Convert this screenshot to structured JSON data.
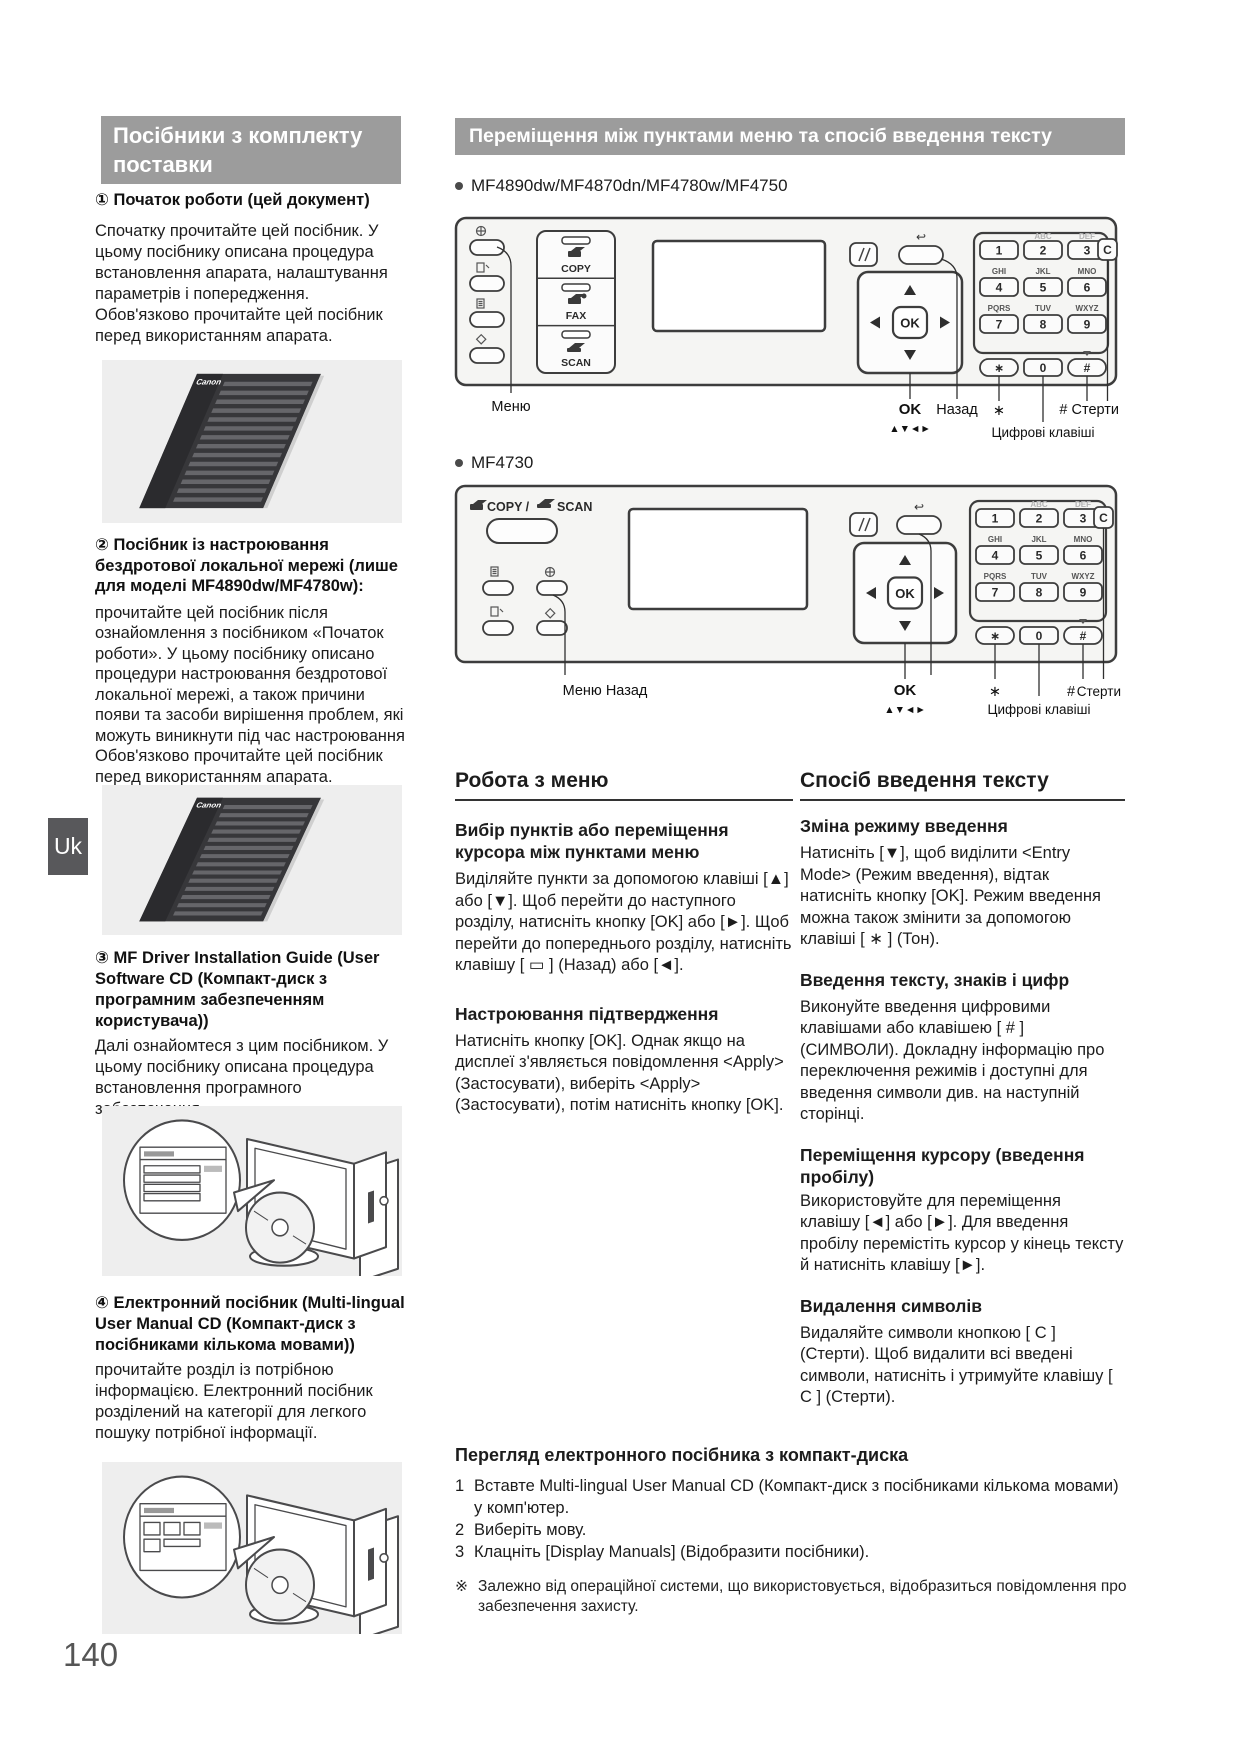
{
  "page": {
    "number": "140",
    "lang_tab": "Uk"
  },
  "left": {
    "header": "Посібники з комплекту поставки",
    "booklet_logo": "Canon",
    "sections": [
      {
        "title": "① Початок роботи (цей документ)",
        "body": "Спочатку прочитайте цей посібник. У цьому посібнику описана процедура встановлення апарата, налаштування параметрів і попередження. Обов'язково прочитайте цей посібник перед використанням апарата."
      },
      {
        "title": "② Посібник із настроювання бездротової локальної мережі (лише для моделі MF4890dw/MF4780w):",
        "body": "прочитайте цей посібник після ознайомлення з посібником «Початок роботи». У цьому посібнику описано процедури настроювання бездротової локальної мережі, а також причини появи та засоби вирішення проблем, які можуть виникнути під час настроювання Обов'язково прочитайте цей посібник перед використанням апарата."
      },
      {
        "title": "③ MF Driver Installation Guide (User Software CD (Компакт-диск з програмним забезпеченням користувача))",
        "body": "Далі ознайомтеся з цим посібником. У цьому посібнику описана процедура встановлення програмного забезпечення."
      },
      {
        "title": "④ Електронний посібник (Multi-lingual User Manual CD (Компакт-диск з посібниками кількома мовами))",
        "body": "прочитайте розділ із потрібною інформацією. Електронний посібник розділений на категорії для легкого пошуку потрібної інформації."
      }
    ]
  },
  "right": {
    "header": "Переміщення між пунктами меню та спосіб введення тексту",
    "model_a": "MF4890dw/MF4870dn/MF4780w/MF4750",
    "model_b": "MF4730"
  },
  "panel": {
    "modes": {
      "copy": "COPY",
      "fax": "FAX",
      "scan": "SCAN"
    },
    "top": {
      "copy": "COPY /",
      "scan": "SCAN"
    },
    "ok": "OK",
    "keypad": {
      "r1": [
        "1",
        "2",
        "3"
      ],
      "r2": [
        "4",
        "5",
        "6"
      ],
      "r3": [
        "7",
        "8",
        "9"
      ],
      "lr1": [
        "ABC",
        "DEF"
      ],
      "lr2": [
        "GHI",
        "JKL",
        "MNO"
      ],
      "lr3": [
        "PQRS",
        "TUV",
        "WXYZ"
      ],
      "zero": "0",
      "star": "∗",
      "hash": "#",
      "clear": "C"
    },
    "labels1": {
      "menu": "Меню",
      "ok": "OK",
      "arrows": "▲▼◄►",
      "back": "Назад",
      "star": "∗",
      "hash_clear": "# Стерти",
      "numeric": "Цифрові клавіші"
    },
    "labels2": {
      "menu_back": "Меню Назад",
      "ok": "OK",
      "arrows": "▲▼◄►",
      "star": "∗",
      "numeric": "Цифрові клавіші",
      "hash": "#",
      "clear": "Стерти"
    }
  },
  "menu_col": {
    "title": "Робота з меню",
    "sub1_title": "Вибір пунктів або переміщення курсора між пунктами меню",
    "sub1_body": "Виділяйте пункти за допомогою клавіші [▲] або [▼]. Щоб перейти до наступного розділу, натисніть кнопку [OK] або [►]. Щоб перейти до попереднього розділу, натисніть клавішу [ ▭ ] (Назад) або [◄].",
    "sub2_title": "Настроювання підтвердження",
    "sub2_body": "Натисніть кнопку [OK]. Однак якщо на дисплеї з'являється повідомлення <Apply> (Застосувати), виберіть <Apply> (Застосувати), потім натисніть кнопку [OK]."
  },
  "text_col": {
    "title": "Спосіб введення тексту",
    "sub1_title": "Зміна режиму введення",
    "sub1_body": "Натисніть [▼], щоб виділити <Entry Mode> (Режим введення), відтак натисніть кнопку [OK]. Режим введення можна також змінити за допомогою клавіші [ ∗ ] (Тон).",
    "sub2_title": "Введення тексту, знаків і цифр",
    "sub2_body": "Виконуйте введення цифровими клавішами або клавішею [ # ] (СИМВОЛИ). Докладну інформацію про переключення режимів і доступні для введення символи див. на наступній сторінці.",
    "sub3_title": "Переміщення курсору (введення пробілу)",
    "sub3_body": "Використовуйте для переміщення клавішу [◄] або [►]. Для введення пробілу перемістіть курсор у кінець тексту й натисніть клавішу [►].",
    "sub4_title": "Видалення символів",
    "sub4_body": "Видаляйте символи кнопкою [ C ] (Стерти). Щоб видалити всі введені символи, натисніть і утримуйте клавішу [ C ] (Стерти)."
  },
  "bottom": {
    "title": "Перегляд електронного посібника з компакт-диска",
    "steps": [
      {
        "n": "1",
        "text": "Вставте Multi-lingual User Manual CD (Компакт-диск з посібниками кількома мовами) у комп'ютер."
      },
      {
        "n": "2",
        "text": "Виберіть мову."
      },
      {
        "n": "3",
        "text": "Клацніть [Display Manuals] (Відобразити посібники)."
      }
    ],
    "note_mark": "※",
    "note": "Залежно від операційної системи, що використовується, відобразиться повідомлення про забезпечення захисту."
  }
}
